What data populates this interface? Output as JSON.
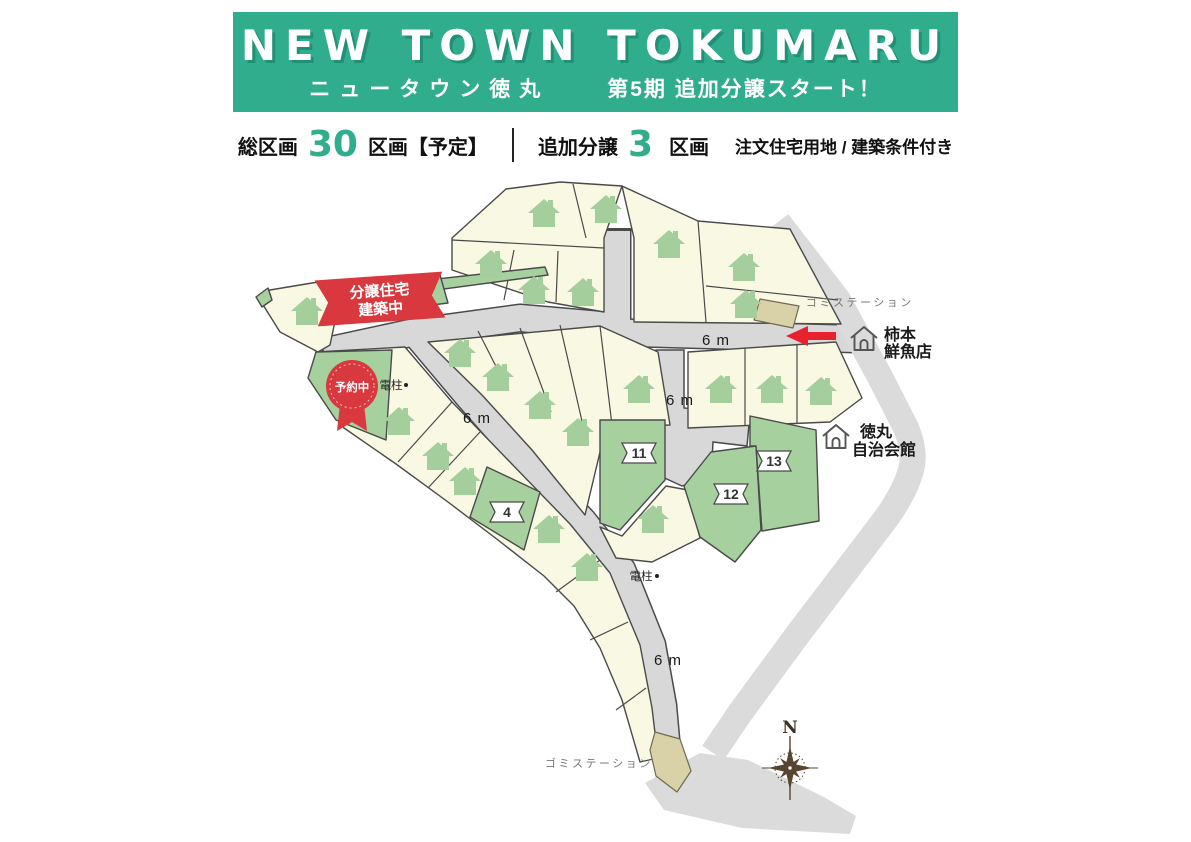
{
  "header": {
    "title_en": "NEW TOWN TOKUMARU",
    "title_jp": "ニュータウン徳丸",
    "campaign": "第5期 追加分譲スタート！"
  },
  "stats": {
    "total_label": "総区画",
    "total_value": "30",
    "total_unit": "区画【予定】",
    "additional_label": "追加分譲",
    "additional_value": "3",
    "additional_unit": "区画",
    "note": "注文住宅用地 / 建築条件付き"
  },
  "map": {
    "road_width_label": "6 m",
    "utility_pole_label": "電柱",
    "garbage_station_label": "ゴミステーション",
    "fish_shop": {
      "line1": "柿本",
      "line2": "鮮魚店"
    },
    "community_hall": {
      "line1": "徳丸",
      "line2": "自治会館"
    },
    "construction_badge": {
      "line1": "分譲住宅",
      "line2": "建築中"
    },
    "reserved_badge": "予約中",
    "compass_north_label": "N",
    "lot_numbers": {
      "lot4": "4",
      "lot11": "11",
      "lot12": "12",
      "lot13": "13"
    },
    "icons": {
      "sold_lot": "house-icon",
      "landmark": "landmark-house-icon",
      "direction": "left-arrow-icon",
      "orientation": "compass-rose-icon"
    }
  },
  "colors": {
    "banner_green": "#2FAD8C",
    "accent_green": "#2FAD8C",
    "lot_cream": "#F9F8E3",
    "lot_green": "#A6D19E",
    "lot_tan": "#D9D2A8",
    "road_gray": "#D8D8D8",
    "outer_road_gray": "#DBDBDB",
    "badge_red": "#D8383E",
    "arrow_red": "#E8222D",
    "house_green": "#A4CE9B"
  }
}
